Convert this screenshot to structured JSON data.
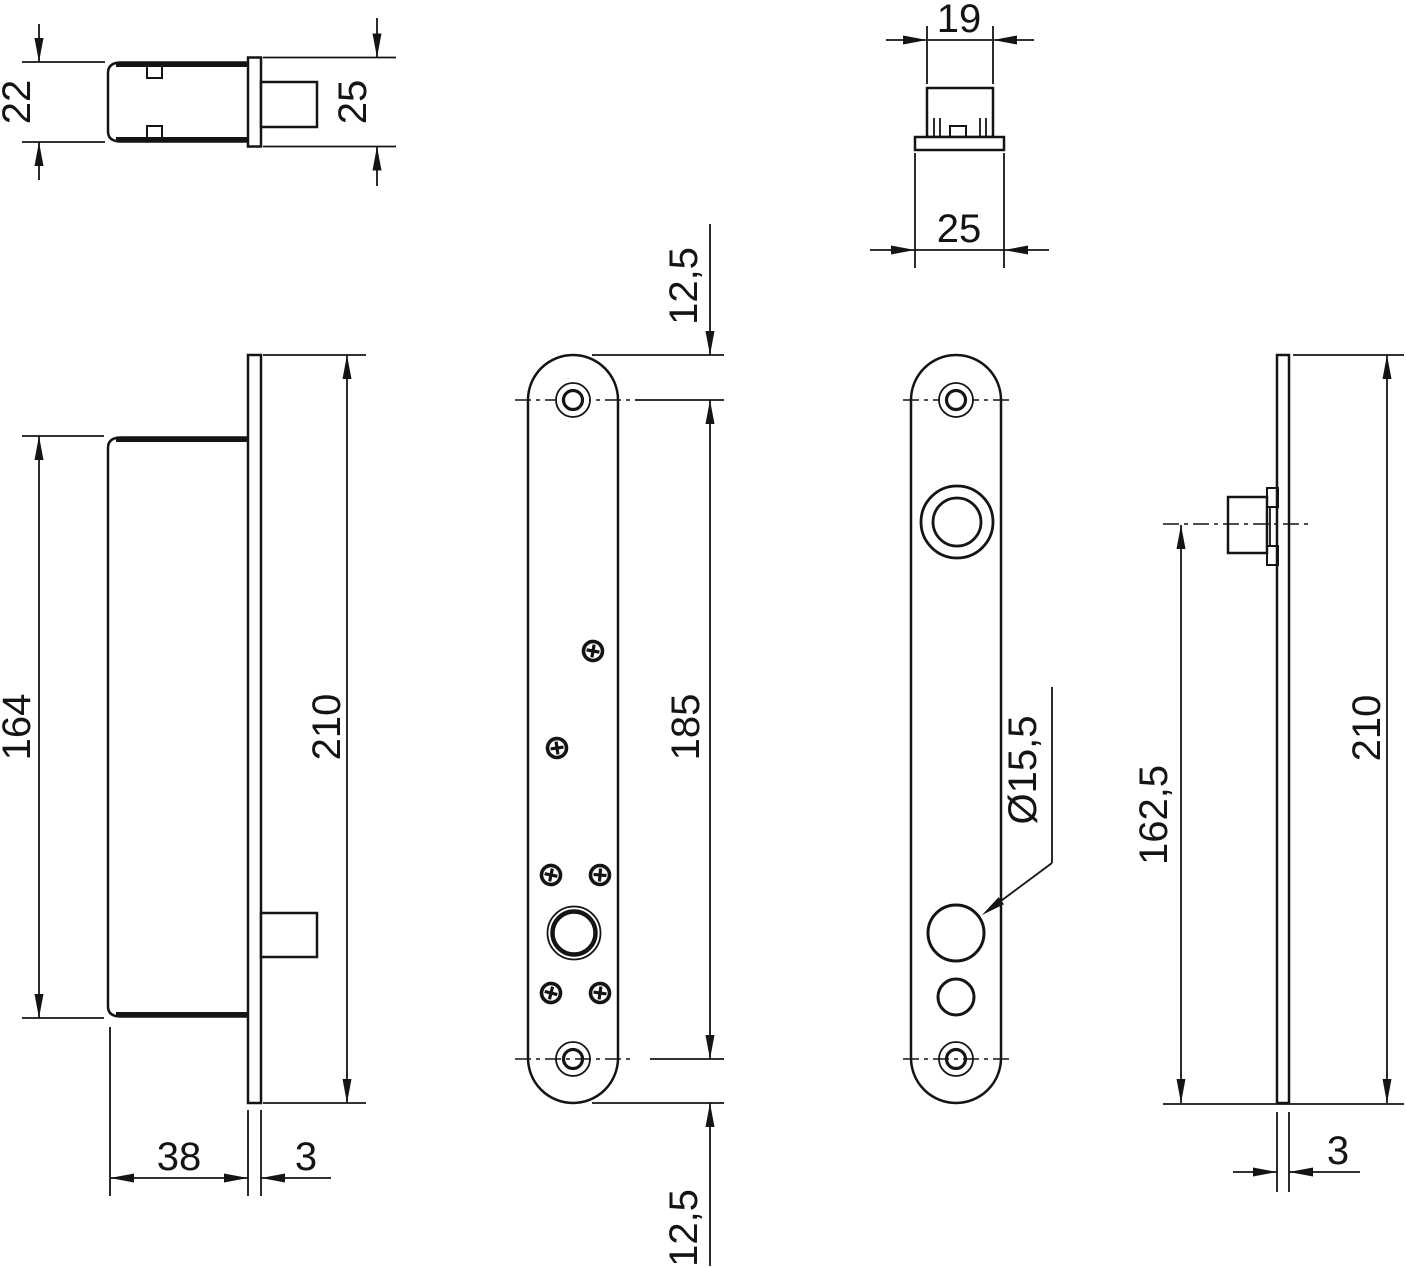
{
  "drawing": {
    "type": "technical-drawing",
    "subject": "lock-with-faceplates",
    "views": {
      "body_top_view": "lock body top view",
      "cylinder_section_view": "cylinder cross section view",
      "body_side_view": "lock body side view",
      "faceplate_front_view": "faceplate front view with screws",
      "backplate_front_view": "back plate front view with holes",
      "plate_edge_view": "plate edge view"
    }
  },
  "dimensions": {
    "body_width_22": "22",
    "plate_width_25_left": "25",
    "block_width_19": "19",
    "plate_width_25_top": "25",
    "body_height_164": "164",
    "plate_height_210_left": "210",
    "body_depth_38": "38",
    "plate_thickness_3_left": "3",
    "hole_top_offset_12_5": "12,5",
    "hole_spacing_185": "185",
    "hole_bottom_offset_12_5": "12,5",
    "hole_diameter_15_5": "Ø15,5",
    "cylinder_offset_162_5": "162,5",
    "plate_height_210_right": "210",
    "plate_thickness_3_right": "3"
  },
  "colors": {
    "line": "#141414",
    "background": "#ffffff"
  }
}
